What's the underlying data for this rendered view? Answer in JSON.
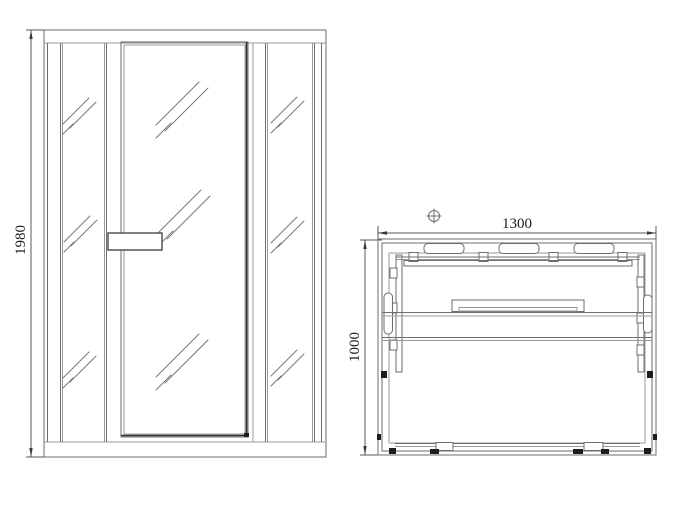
{
  "drawing": {
    "type": "technical-drawing",
    "views": {
      "front_elevation": {
        "name": "front elevation of sauna cabin",
        "height_dimension": "1980"
      },
      "plan": {
        "name": "top plan view of sauna cabin",
        "width_dimension": "1300",
        "depth_dimension": "1000"
      }
    },
    "icons": {
      "position_marker": "circle-with-cross ⊕",
      "glass_hatch": "three diagonal glass lines ///"
    },
    "colors": {
      "line": "#6e6e6e",
      "line_dark": "#2e2e2e",
      "dimension": "#585858",
      "text": "#1b1b1b",
      "background": "#ffffff"
    }
  }
}
